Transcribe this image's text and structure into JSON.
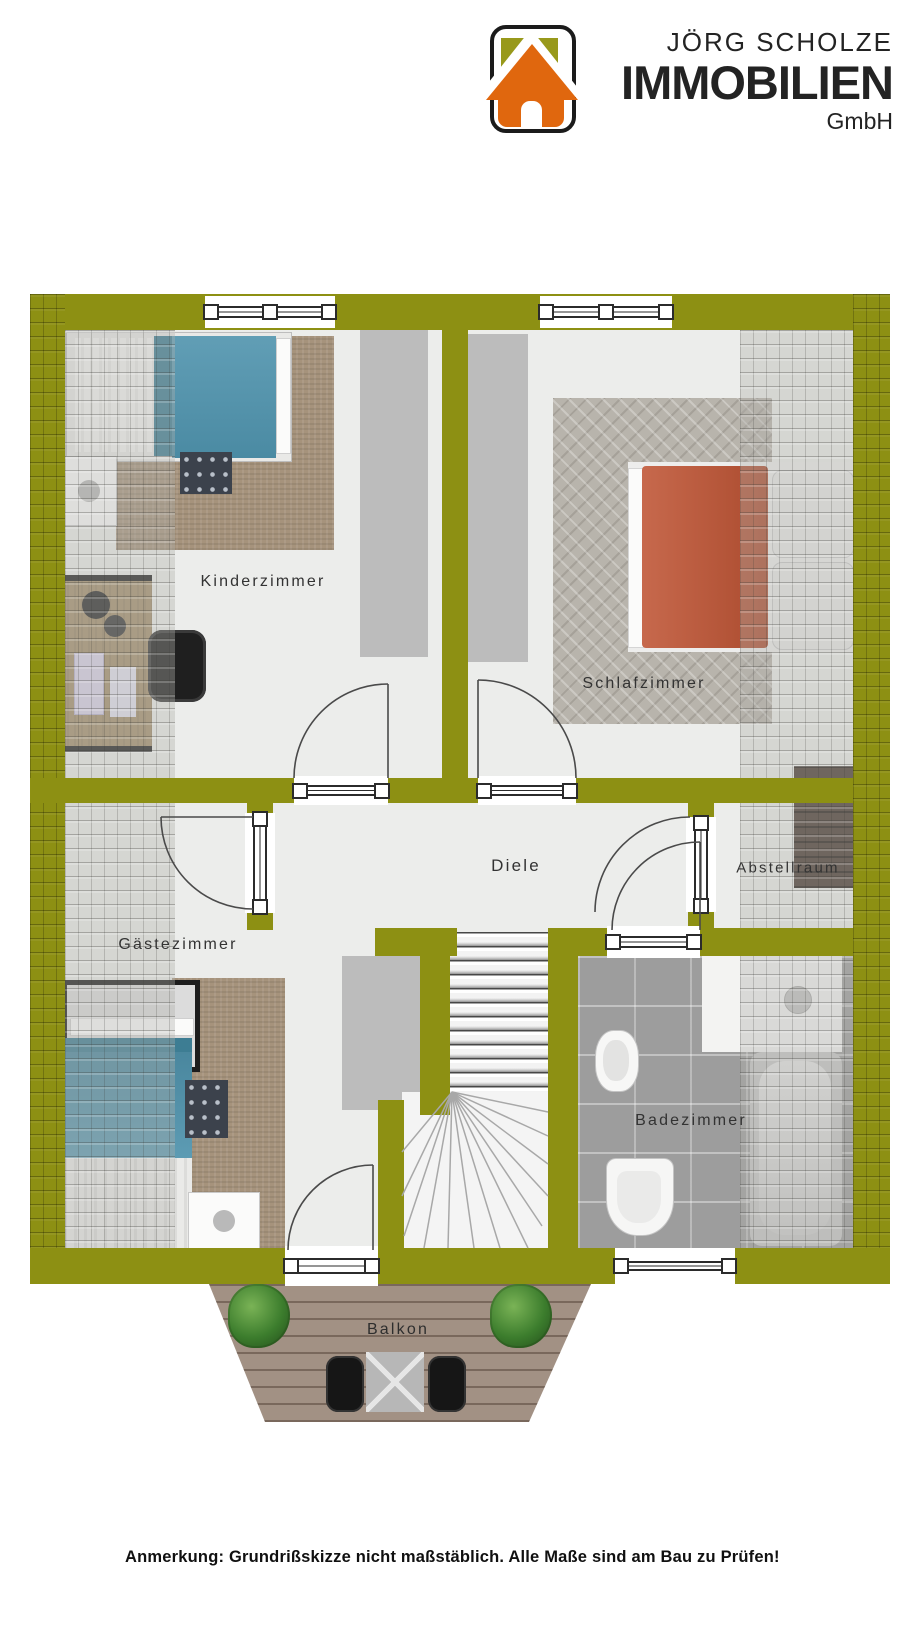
{
  "brand": {
    "name": "JÖRG SCHOLZE",
    "company": "IMMOBILIEN",
    "legal_form": "GmbH"
  },
  "floorplan": {
    "rooms": {
      "kinderzimmer": {
        "label": "Kinderzimmer"
      },
      "schlafzimmer": {
        "label": "Schlafzimmer"
      },
      "diele": {
        "label": "Diele"
      },
      "abstellraum": {
        "label": "Abstellraum"
      },
      "gaestezimmer": {
        "label": "Gästezimmer"
      },
      "badezimmer": {
        "label": "Badezimmer"
      },
      "balkon": {
        "label": "Balkon"
      }
    },
    "colors": {
      "wall_olive": "#8d9013",
      "logo_olive": "#98991b",
      "logo_orange": "#e0670e",
      "floor": "#ecedeb"
    }
  },
  "note": {
    "text": "Anmerkung: Grundrißskizze nicht maßstäblich. Alle Maße sind am Bau zu Prüfen!"
  }
}
